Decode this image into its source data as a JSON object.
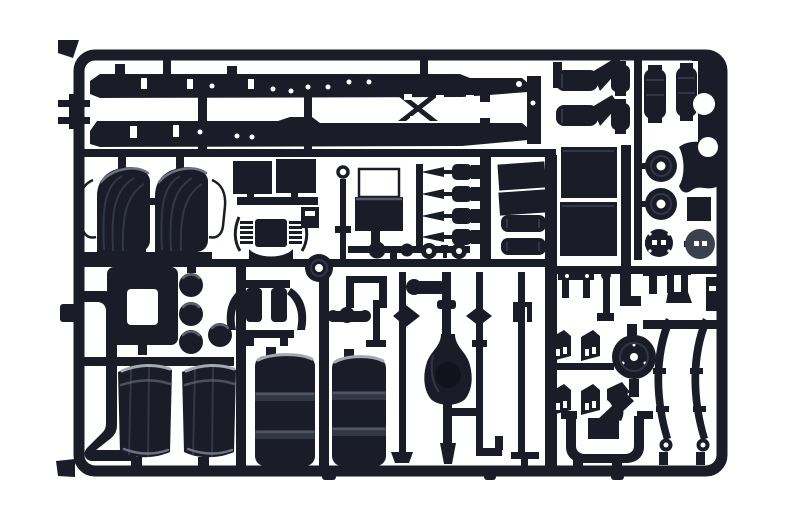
{
  "meta": {
    "kind": "photograph",
    "subject": "Injection-molded plastic model kit sprue (parts tree) of truck chassis components, photographed on a plain white background",
    "width_px": 800,
    "height_px": 530
  },
  "palette": {
    "background": "#ffffff",
    "plastic": "#1a1d27",
    "plastic_dark": "#10131a",
    "plastic_mid": "#323748",
    "glare": "#6d7380",
    "glare_bright": "#a3a8b2",
    "hub_grey": "#3c414e"
  },
  "scene": {
    "material": "dark blue-black polystyrene",
    "layout": "rectangular sprue frame with rounded corners, internal runners connecting parts",
    "bands": [
      "top: two long chassis side rails and rear frame section, mufflers, air tanks, brake drums and hubs",
      "middle: front fenders, flat panels, cab suspension, battery box, four shock absorbers, horizontal air reservoirs, large flat panels",
      "bottom: exhaust pipe, two large rear fenders, two cylindrical fuel tanks, axles with differentials, steering rods, brake chamber brackets, differential cover, two leaf springs, U-shaped pipe"
    ]
  },
  "parts": [
    {
      "id": "sprue-frame",
      "label": "Outer sprue frame with rounded corners"
    },
    {
      "id": "runner-network",
      "label": "Internal runner bars and gate stubs"
    },
    {
      "id": "chassis-rail-top",
      "label": "Chassis side rail (upper)"
    },
    {
      "id": "chassis-rail-bottom",
      "label": "Chassis side rail (lower)"
    },
    {
      "id": "rear-frame-section",
      "label": "Rear frame section with X-crossmember and end plate"
    },
    {
      "id": "frame-tee-parts",
      "label": "Small T-shaped brackets on left frame edge"
    },
    {
      "id": "mufflers",
      "label": "Two mufflers with angled brackets"
    },
    {
      "id": "small-air-cylinders",
      "label": "Two small air cylinders"
    },
    {
      "id": "vertical-air-tanks",
      "label": "Two vertical air reservoir tanks"
    },
    {
      "id": "right-edge-plate",
      "label": "Shaped plate with round cutouts on right frame edge"
    },
    {
      "id": "top-right-tab",
      "label": "Small mounting tab on top frame edge"
    },
    {
      "id": "brake-drums",
      "label": "Two brake drums with center holes"
    },
    {
      "id": "wheel-hubs",
      "label": "Two wheel hubs with slotted centers"
    },
    {
      "id": "mudguard-brackets",
      "label": "Curved mudguard bracket and small plate"
    },
    {
      "id": "front-fender-left",
      "label": "Front fender (left) with wire support frame"
    },
    {
      "id": "front-fender-right",
      "label": "Front fender (right) with wire support frame"
    },
    {
      "id": "small-flat-panels",
      "label": "Two small flat panels on mounting bar"
    },
    {
      "id": "cab-mount-box",
      "label": "Small cab mount box"
    },
    {
      "id": "cab-suspension",
      "label": "Cab suspension with coil springs and curved base"
    },
    {
      "id": "idler-pulley",
      "label": "Small wheel / idler pulley"
    },
    {
      "id": "ring-pin-rod",
      "label": "Long pin rod with ring head"
    },
    {
      "id": "battery-box",
      "label": "Battery box with wire carrier frame"
    },
    {
      "id": "linkage-row",
      "label": "Row of ball joints and washers on runner"
    },
    {
      "id": "shock-absorbers",
      "label": "Four shock absorbers"
    },
    {
      "id": "tilted-panels",
      "label": "Two tilted flat panels"
    },
    {
      "id": "horizontal-air-tanks",
      "label": "Two horizontal air reservoirs"
    },
    {
      "id": "large-panels",
      "label": "Two large flat rectangular panels"
    },
    {
      "id": "engine-mount-frame",
      "label": "Engine mount frame with rectangular opening"
    },
    {
      "id": "hub-cap-domes",
      "label": "Four domed hub caps"
    },
    {
      "id": "air-filter-assembly",
      "label": "Air filter assembly with twin cylinders and curved tubes"
    },
    {
      "id": "exhaust-pipe",
      "label": "J-shaped exhaust pipe with foot flange"
    },
    {
      "id": "rear-fender-left",
      "label": "Large rear fender (left)"
    },
    {
      "id": "rear-fender-right",
      "label": "Large rear fender (right)"
    },
    {
      "id": "fuel-tank-left",
      "label": "Cylindrical fuel tank (left) with mounting bands"
    },
    {
      "id": "fuel-tank-right",
      "label": "Cylindrical fuel tank (right) with mounting bands"
    },
    {
      "id": "front-axle-differential",
      "label": "Axle with large differential housing"
    },
    {
      "id": "steering-rods",
      "label": "Steering and tie rods with ball ends"
    },
    {
      "id": "drive-rods",
      "label": "Drive shafts and linkage rods"
    },
    {
      "id": "spring-hangers",
      "label": "Spring hanger shackles and small brackets"
    },
    {
      "id": "brake-chamber-brackets",
      "label": "Four brake chamber brackets with slots"
    },
    {
      "id": "differential-cover",
      "label": "Round differential cover with flange"
    },
    {
      "id": "leaf-springs",
      "label": "Two curved leaf springs with eyes"
    },
    {
      "id": "u-pipe",
      "label": "U-shaped pipe with flanged ends and plate"
    }
  ]
}
